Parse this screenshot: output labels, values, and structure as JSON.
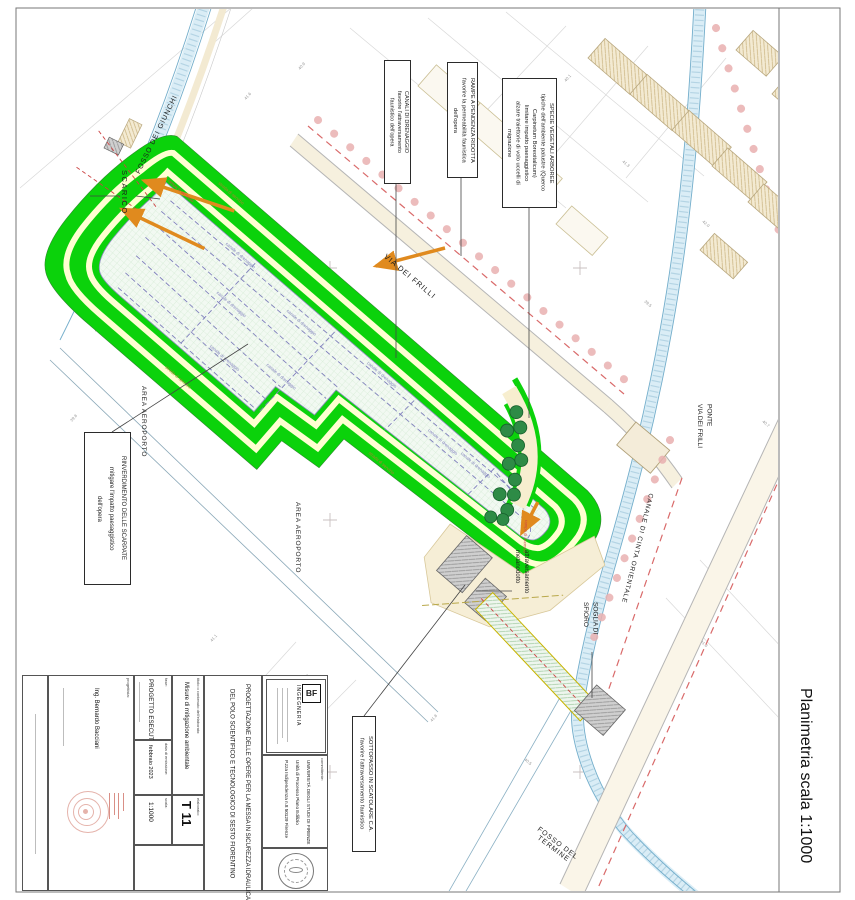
{
  "sheet": {
    "frame_title": "Planimetria scala 1:1000"
  },
  "colors": {
    "embankment_green": "#0bd20b",
    "berm_cream": "#ffffd2",
    "basin_interior": "#f2f9f2",
    "drain_purple": "#8080bd",
    "road_tan": "#f6f0de",
    "water_blue": "#74aecb",
    "tree_green": "#2e8b46",
    "dash_red": "#d96a6a",
    "tree_row_pink": "#e9b0b0",
    "structure_gray": "#cfcfcf"
  },
  "callouts": {
    "specie": {
      "lines": [
        "SPECIE VEGETALI ARBOREE",
        "tipiche dell'ambiente palustre (Querco",
        "Carpinetum Boreoitalicum)",
        "limitare impatto paesaggistico",
        "alzare traiettorie di volo uccelli di",
        "migrazione"
      ]
    },
    "rampe": {
      "lines": [
        "RAMPE A PENDENZA RIDOTTA",
        "favorire la permeabilità faunistica",
        "dell'opera"
      ]
    },
    "canali": {
      "lines": [
        "CANALI DI DRENAGGIO",
        "favorire l'attraversamento",
        "faunistico dell'opera"
      ]
    },
    "rinverdimento": {
      "lines": [
        "RINVERDIMENTO DELLE SCARPATE",
        "mitigare l'impatto paesaggistico",
        "dell'opera"
      ]
    },
    "sottopasso": {
      "lines": [
        "SOTTOPASSO IN SCATOLARE C.A.",
        "favorire l'attraversamento faunistico"
      ]
    }
  },
  "labels": {
    "scarico": "SCARICO",
    "fosso_giunchi": "FOSSO DEI GIUNCHI",
    "via_frilli": "VIA DEI FRILLI",
    "area_aeroporto": "AREA AEROPORTO",
    "ponte": [
      "PONTE",
      "VIA DEI FRILLI"
    ],
    "canale_cinta": "CANALE DI CINTA ORIENTALE",
    "fosso_termine": [
      "FOSSO DEL",
      "TERMINE"
    ],
    "soglia": [
      "SOGLIA DI",
      "SFIORO"
    ],
    "attraversamento": [
      "attraversamento",
      "metanodotto"
    ],
    "canale_drenaggio": "canale di drenaggio",
    "strada_servizio": "strada di servizio",
    "rampa_accesso": "rampa di accesso"
  },
  "elevations": [
    "41.6",
    "40.9",
    "42.3",
    "39.8",
    "41.1",
    "40.2",
    "41.8",
    "40.5",
    "39.5",
    "42.0",
    "41.3",
    "40.7",
    "41.9",
    "40.1"
  ],
  "title_block": {
    "designer_label": "progettista:",
    "designer": "Ing. Bernardo Bacciani",
    "phase_label": "fase:",
    "phase": "PROGETTO ESECUTIVO",
    "date_label": "data di emissione:",
    "date": "febbraio 2023",
    "scale_label": "scala:",
    "scale": "1:1000",
    "content_label": "titolo o contenuto dell'elaborato:",
    "content": "Misure di mitigazione ambientale",
    "sheet_label": "elaborato:",
    "sheet_code": "T 11",
    "project_title": [
      "PROGETTAZIONE DELLE OPERE PER LA MESSA IN SICUREZZA IDRAULICA",
      "DEL POLO SCIENTIFICO E TECNOLOGICO DI SESTO FIORENTINO"
    ],
    "client_label": "committente:",
    "client": [
      "UNIVERSITÀ DEGLI STUDI DI FIRENZE",
      "Unità di Processo Piano Edilizio",
      "P.zza Indipendenza n.8 50129 Firenze"
    ],
    "logo_initials": "BF",
    "logo_name": "INGEGNERIA"
  }
}
